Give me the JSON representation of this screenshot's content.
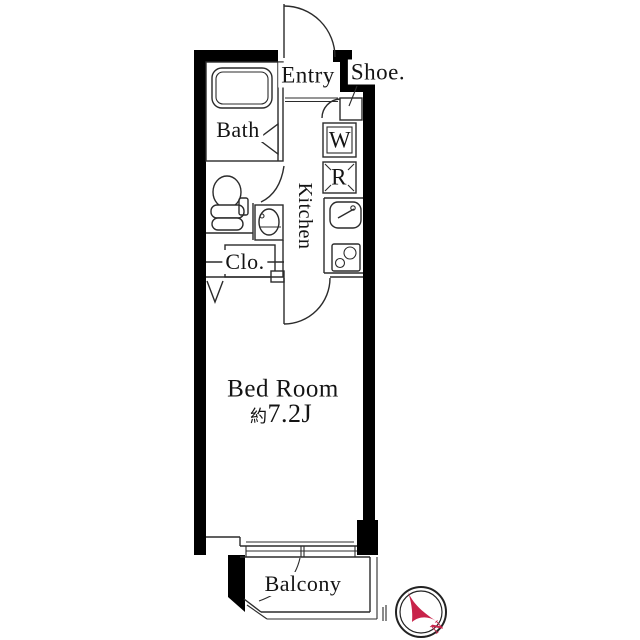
{
  "floorplan": {
    "rooms": {
      "entry": "Entry",
      "shoe": "Shoe.",
      "bath": "Bath",
      "kitchen": "Kitchen",
      "closet": "Clo.",
      "washer": "W",
      "refrigerator": "R",
      "bedroom_name": "Bed Room",
      "bedroom_size_prefix": "約",
      "bedroom_size_value": "7.2J",
      "balcony": "Balcony"
    },
    "compass": {
      "north": "N"
    },
    "colors": {
      "wall": "#000000",
      "line": "#2b2b2b",
      "accent_red": "#c8234a"
    }
  }
}
